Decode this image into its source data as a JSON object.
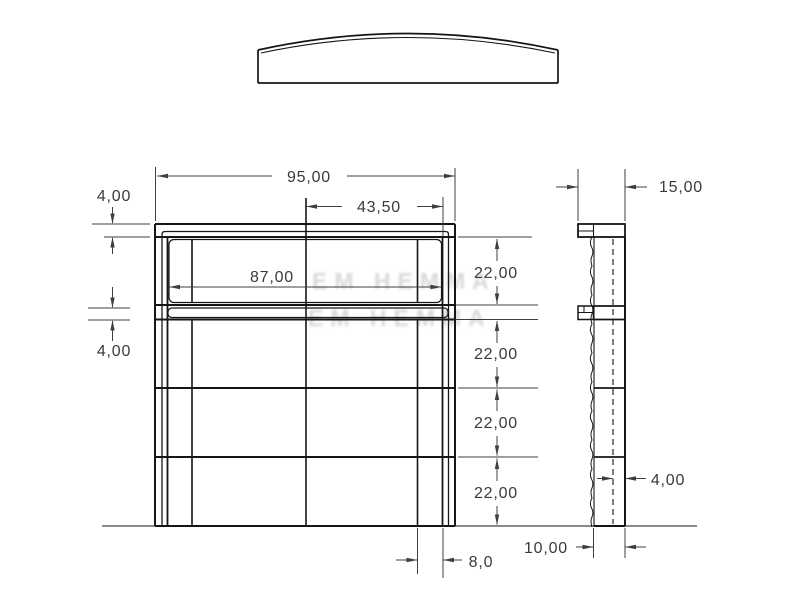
{
  "drawing": {
    "kind": "technical-orthographic-drawing",
    "units_style": "comma-decimal",
    "dims": {
      "front": {
        "total_width": "95,00",
        "half_opening_width": "43,50",
        "cap_thickness": "4,00",
        "opening_width": "87,00",
        "mid_rail_thickness": "4,00",
        "row_heights": [
          "22,00",
          "22,00",
          "22,00",
          "22,00"
        ],
        "stile_width": "8,0"
      },
      "side": {
        "overall_depth": "15,00",
        "leg_depth": "10,00",
        "panel_thickness": "4,00"
      }
    },
    "watermark": {
      "line1": "EM HEMMA",
      "line2": "EM HEMMA"
    },
    "colors": {
      "line": "#161616",
      "dimension": "#3f3f3f",
      "text": "#3a3a3a",
      "watermark": "#b9b9bf",
      "background": "#ffffff"
    }
  }
}
